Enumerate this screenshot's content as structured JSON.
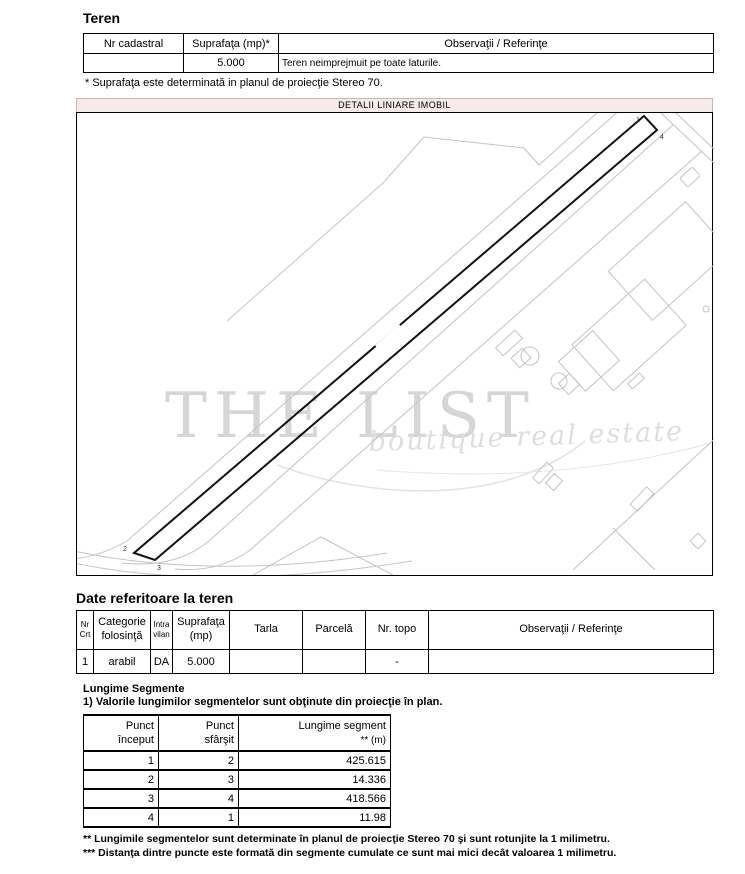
{
  "colors": {
    "map_header_bg": "#f6ebeb",
    "watermark_main": "#d6d6d6",
    "watermark_sub": "#dedede",
    "sketch_gray": "#c4c4c4",
    "parcel_black": "#111111"
  },
  "teren": {
    "title": "Teren",
    "table": {
      "headers": [
        "Nr cadastral",
        "Suprafaţa (mp)*",
        "Observaţii / Referinţe"
      ],
      "row": {
        "nr_cadastral": "",
        "suprafata": "5.000",
        "observatii": "Teren neimprejmuit pe toate laturile."
      }
    },
    "footnote": "* Suprafaţa este determinată in planul de proiecţie Stereo 70."
  },
  "map": {
    "title": "DETALII LINIARE IMOBIL",
    "watermark_line1": "THE LIST",
    "watermark_line2": "boutique  real  estate",
    "points": {
      "p1": "1",
      "p2": "2",
      "p3": "3",
      "p4": "4"
    }
  },
  "date_teren": {
    "title": "Date referitoare la teren",
    "headers": {
      "nr_l1": "Nr",
      "nr_l2": "Crt",
      "cat_l1": "Categorie",
      "cat_l2": "folosinţă",
      "intra_l1": "Intra",
      "intra_l2": "vilan",
      "supr_l1": "Suprafaţa",
      "supr_l2": "(mp)",
      "tarla": "Tarla",
      "parcela": "Parcelă",
      "topo": "Nr. topo",
      "obs": "Observaţii / Referinţe"
    },
    "row": [
      "1",
      "arabil",
      "DA",
      "5.000",
      "",
      "",
      "-",
      ""
    ]
  },
  "segments": {
    "title": "Lungime Segmente",
    "note": "1) Valorile lungimilor segmentelor sunt obţinute din proiecţie în plan.",
    "col_start_l1": "Punct",
    "col_start_l2": "început",
    "col_end_l1": "Punct",
    "col_end_l2": "sfârşit",
    "col_len_l1": "Lungime segment",
    "col_len_l2": "** (m)",
    "rows": [
      [
        "1",
        "2",
        "425.615"
      ],
      [
        "2",
        "3",
        "14.336"
      ],
      [
        "3",
        "4",
        "418.566"
      ],
      [
        "4",
        "1",
        "11.98"
      ]
    ],
    "footnote_2star": "** Lungimile segmentelor sunt determinate în planul de proiecţie Stereo 70 şi sunt rotunjite la 1 milimetru.",
    "footnote_3star": "*** Distanţa dintre puncte este formată din segmente cumulate ce sunt mai mici decât valoarea 1 milimetru."
  }
}
